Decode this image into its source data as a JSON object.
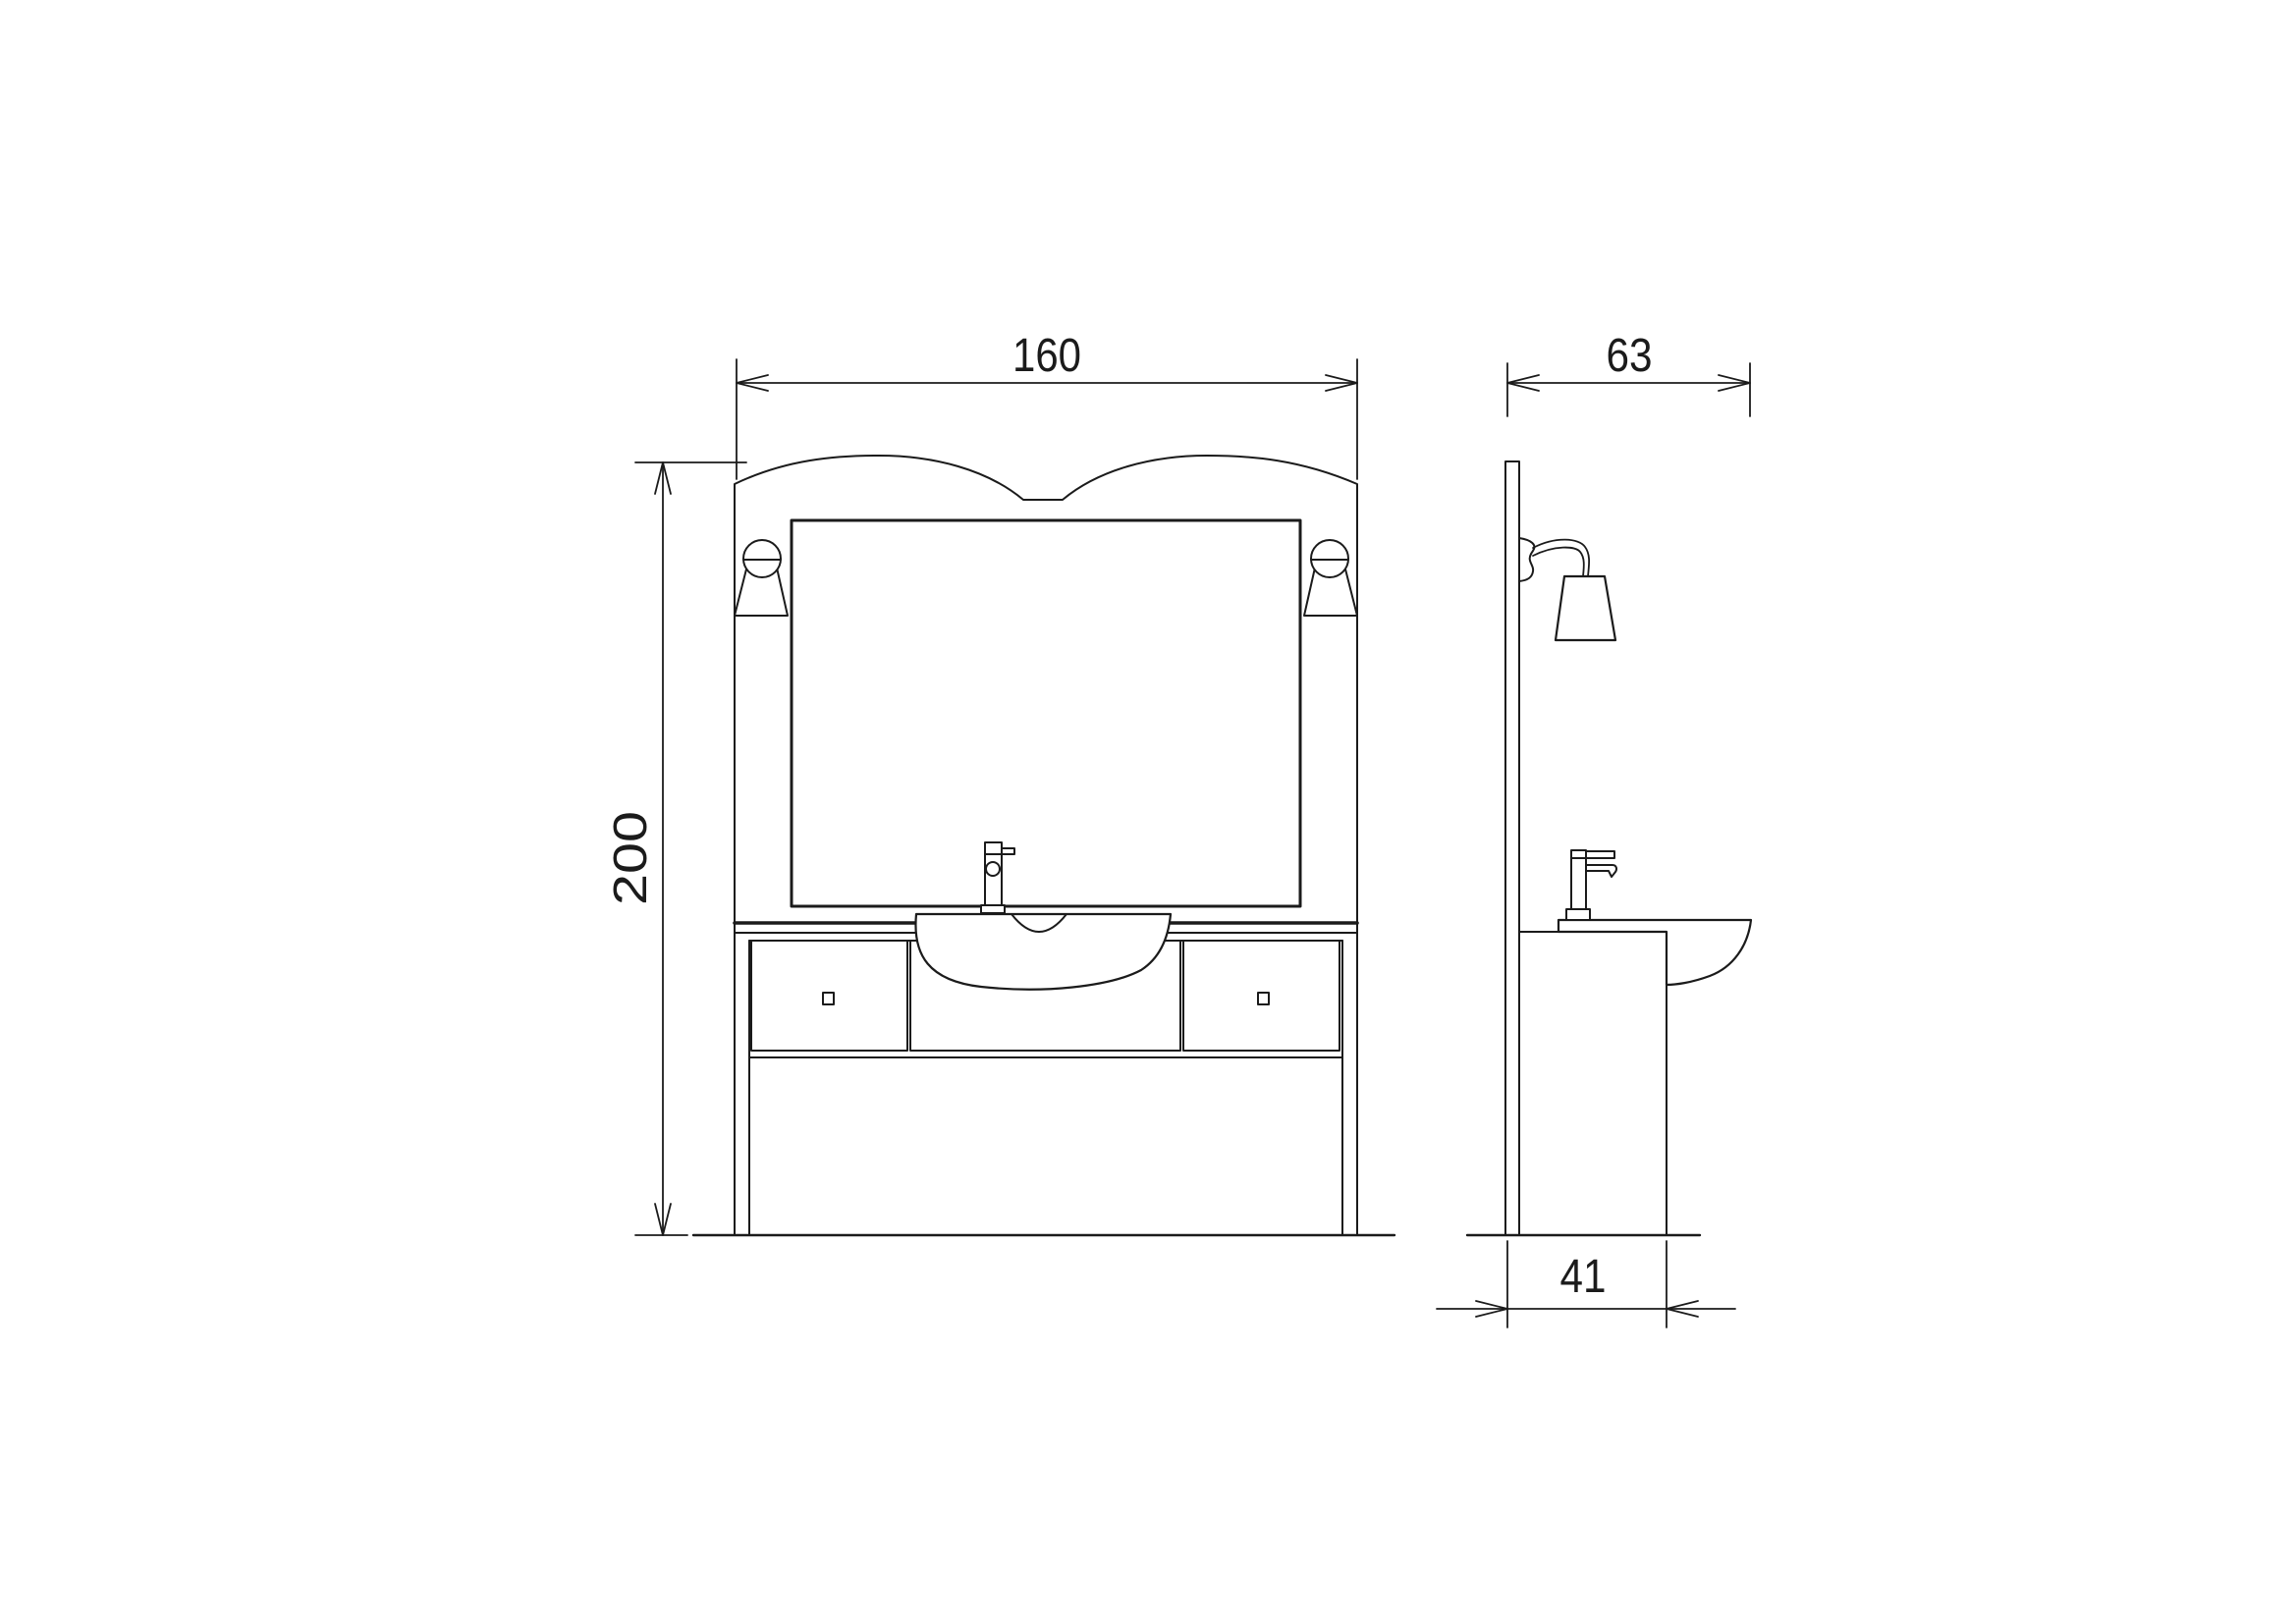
{
  "page": {
    "background": "#ffffff",
    "line_color": "#1b1b1b"
  },
  "drawing": {
    "type": "technical-orthographic-elevation",
    "subject": "bathroom vanity unit with arched mirror panel, two wall lamps, basin, faucet and drawer cabinet",
    "views": [
      {
        "id": "front",
        "label": "front elevation",
        "components": [
          "arched back panel",
          "mirror",
          "left wall lamp",
          "right wall lamp",
          "faucet",
          "wash basin",
          "countertop",
          "left drawer",
          "center drawer front",
          "right drawer",
          "lower panel",
          "floor line"
        ]
      },
      {
        "id": "side",
        "label": "side elevation",
        "components": [
          "wall panel",
          "wall lamp",
          "faucet",
          "basin profile",
          "cabinet",
          "floor line"
        ]
      }
    ],
    "dimensions": {
      "front_width": {
        "value": "160",
        "orientation": "horizontal",
        "measures": "overall width of front elevation"
      },
      "overall_height": {
        "value": "200",
        "orientation": "vertical",
        "measures": "overall height from floor to top of panel"
      },
      "side_depth": {
        "value": "63",
        "orientation": "horizontal",
        "measures": "overall depth of side elevation including basin"
      },
      "cabinet_depth": {
        "value": "41",
        "orientation": "horizontal",
        "measures": "cabinet depth at floor"
      }
    }
  }
}
